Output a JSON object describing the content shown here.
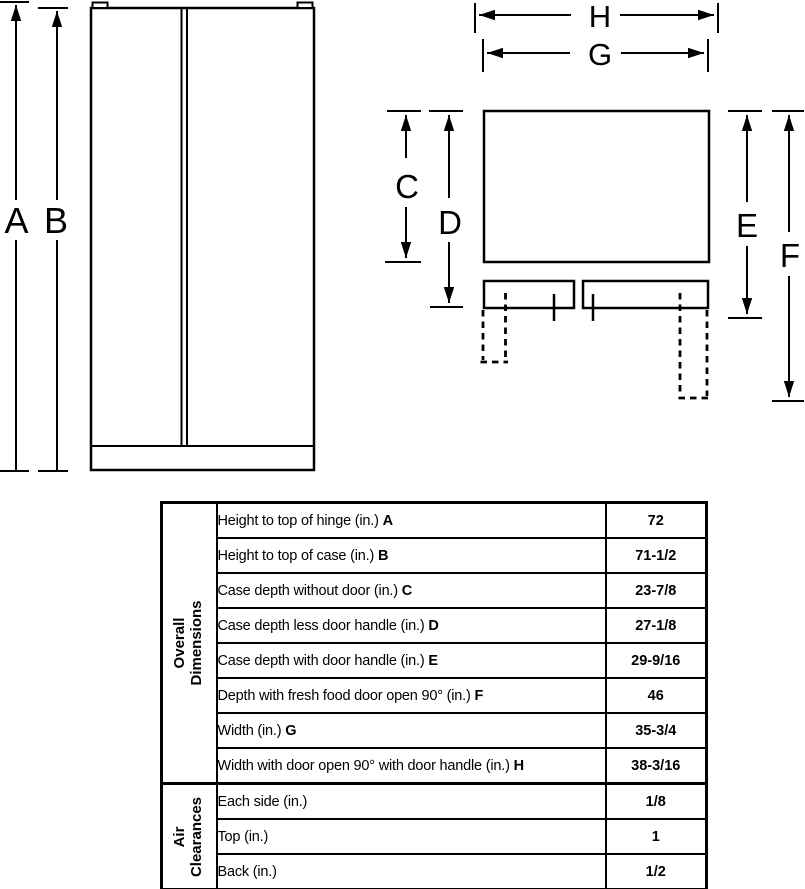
{
  "page": {
    "background_color": "#ffffff",
    "line_color": "#000000",
    "text_color": "#000000"
  },
  "diagram": {
    "front_view": {
      "letters": {
        "a": "A",
        "b": "B"
      }
    },
    "top_view": {
      "letters": {
        "c": "C",
        "d": "D",
        "e": "E",
        "f": "F",
        "g": "G",
        "h": "H"
      }
    }
  },
  "table": {
    "sections": [
      {
        "header_lines": [
          "Overall",
          "Dimensions"
        ],
        "rows": [
          {
            "label": "Height to top of hinge (in.)",
            "letter": "A",
            "value": "72"
          },
          {
            "label": "Height to top of case (in.)",
            "letter": "B",
            "value": "71-1/2"
          },
          {
            "label": "Case depth without door (in.)",
            "letter": "C",
            "value": "23-7/8"
          },
          {
            "label": "Case depth less door handle (in.)",
            "letter": "D",
            "value": "27-1/8"
          },
          {
            "label": "Case depth with door handle (in.)",
            "letter": "E",
            "value": "29-9/16"
          },
          {
            "label": "Depth with fresh food door open 90° (in.)",
            "letter": "F",
            "value": "46"
          },
          {
            "label": "Width (in.)",
            "letter": "G",
            "value": "35-3/4"
          },
          {
            "label": "Width with door open 90° with door handle (in.)",
            "letter": "H",
            "value": "38-3/16"
          }
        ]
      },
      {
        "header_lines": [
          "Air",
          "Clearances"
        ],
        "rows": [
          {
            "label": "Each side (in.)",
            "letter": "",
            "value": "1/8"
          },
          {
            "label": "Top (in.)",
            "letter": "",
            "value": "1"
          },
          {
            "label": "Back (in.)",
            "letter": "",
            "value": "1/2"
          }
        ]
      }
    ]
  }
}
